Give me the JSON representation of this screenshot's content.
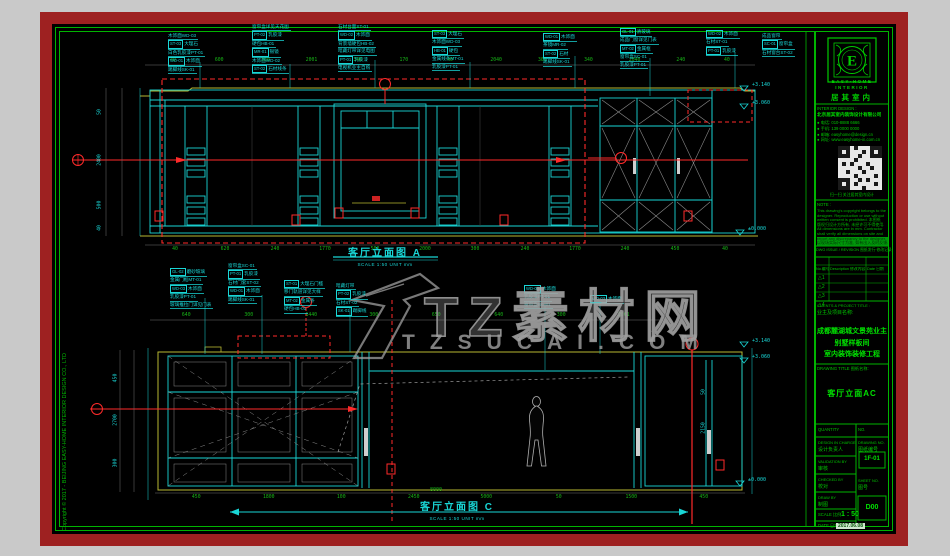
{
  "page": {
    "bg": "#c9c9c9",
    "frame": "#9e2121",
    "paper": "#000000",
    "border_green": "#00b400",
    "cyan": "#19d6d6",
    "yellow": "#b8b832",
    "red": "#ff2a2a",
    "dim_green": "#17b517",
    "gray": "#8f8f8f"
  },
  "copyright": "Copyright © 2017 - BEIJING EASY-HOME INTERIOR DESIGN CO., LTD",
  "logo": {
    "letter": "E",
    "en1": "EASY·HOME",
    "en2": "INTERIOR",
    "cn": "居其室内"
  },
  "title_block": {
    "interior_design_label": "INTERIOR DESIGN :",
    "company": "北京居其室内装饰设计有限公司",
    "contacts": [
      "● 电话: 010-8888 6666",
      "● 手机: 139 0000 0000",
      "● 邮箱: easyhome@design.cn",
      "● 网址: www.easyhome-in.com.cn"
    ],
    "qr_caption": "扫一扫 关注居其室内设计",
    "note_label": "NOTE :",
    "notes": [
      "This drawing's copyright belongs to the",
      "designer. Reproduction or use without",
      "written consent is prohibited. 本图纸",
      "版权归设计方所有, 未经许可不得使用.",
      "All dimensions are in mm. Contractor",
      "shall verify all dimensions on site and",
      "report any discrepancy to the designer.",
      "以现场实际尺寸为准, 如有出入及时反馈."
    ],
    "issue_label": "DWG ISSUE / REVISION 图纸发行·修改记录",
    "table": {
      "headers": [
        "No.编号",
        "Description 修改内容",
        "Date 日期"
      ],
      "rows": [
        "1",
        "2",
        "3",
        "4"
      ]
    },
    "clients_label": "CLIENTS & PROJECT TITLE :",
    "clients_label_cn": "业主及项目名称:",
    "project_lines": [
      "成都麓湖城文景苑业主",
      "别墅样板间",
      "室内装饰装修工程"
    ],
    "drawing_title_label": "DRAWING TITLE 图纸名称:",
    "drawing_title": "客厅立面AC",
    "quantity_label": "QUANTITY",
    "no_label": "NO.",
    "design_in_charge": "DESIGN IN CHARGE",
    "design_in_charge_cn": "设计负责人",
    "drawing_no_label": "DRAWING NO.",
    "drawing_no_cn": "图纸编号",
    "drawing_no": "1F-01",
    "validation_label": "VALIDATION BY",
    "validation_cn": "审核",
    "checked_label": "CHECKED BY",
    "checked_cn": "校对",
    "draw_label": "DRAW BY",
    "draw_cn": "制图",
    "sheet_label": "SHEET NO.",
    "sheet_cn": "图号",
    "sheet_no": "D00",
    "scale_label": "SCALE 比例",
    "scale_value": "1 : 50",
    "date_label": "DATE 日期",
    "date_value": "2017.06.08"
  },
  "watermark": {
    "big_text": "TZ素材网",
    "domain": "TZSUCAI.COM"
  },
  "drawing": {
    "elev_a": {
      "title": "客厅立面图 A",
      "scale_note": "SCALE 1:50   UNIT mm"
    },
    "elev_c": {
      "title": "客厅立面图 C",
      "scale_note": "SCALE 1:50   UNIT mm",
      "overall_dim": "8000"
    },
    "flags": [
      {
        "x": 752,
        "y": 82,
        "t": "+3.140"
      },
      {
        "x": 752,
        "y": 100,
        "t": "+3.060"
      },
      {
        "x": 748,
        "y": 226,
        "t": "±0.000"
      },
      {
        "x": 752,
        "y": 338,
        "t": "+3.140"
      },
      {
        "x": 752,
        "y": 354,
        "t": "+3.060"
      },
      {
        "x": 748,
        "y": 477,
        "t": "±0.000"
      }
    ],
    "dim_rows": [
      {
        "y": 58,
        "x1": 150,
        "x2": 750,
        "values": [
          "40",
          "600",
          "300",
          "2001",
          "340",
          "170",
          "40",
          "2040",
          "300",
          "340",
          "2040",
          "240",
          "40"
        ]
      },
      {
        "y": 247,
        "x1": 150,
        "x2": 750,
        "values": [
          "40",
          "620",
          "240",
          "1770",
          "500",
          "2000",
          "300",
          "240",
          "1770",
          "240",
          "450",
          "40"
        ]
      },
      {
        "y": 313,
        "x1": 155,
        "x2": 655,
        "values": [
          "640",
          "300",
          "1440",
          "300",
          "650",
          "640",
          "300",
          "2001"
        ]
      },
      {
        "y": 495,
        "x1": 160,
        "x2": 740,
        "values": [
          "450",
          "1800",
          "100",
          "2450",
          "5000",
          "50",
          "1500",
          "450"
        ]
      }
    ],
    "vdims": [
      {
        "x": 100,
        "y": 112,
        "t": "50"
      },
      {
        "x": 100,
        "y": 160,
        "t": "2400"
      },
      {
        "x": 100,
        "y": 205,
        "t": "500"
      },
      {
        "x": 100,
        "y": 228,
        "t": "40"
      },
      {
        "x": 116,
        "y": 378,
        "t": "450"
      },
      {
        "x": 116,
        "y": 420,
        "t": "2700"
      },
      {
        "x": 116,
        "y": 463,
        "t": "300"
      },
      {
        "x": 704,
        "y": 392,
        "t": "50"
      },
      {
        "x": 704,
        "y": 428,
        "t": "2150"
      }
    ],
    "callouts": [
      {
        "x": 168,
        "y": 33,
        "lines": [
          "木饰面WD-03",
          "[ST-03] 大理石",
          "白色乳胶漆PT-01",
          "[WD-01] 木饰面",
          "踢脚线SK-01"
        ]
      },
      {
        "x": 252,
        "y": 24,
        "lines": [
          "窗帘盒详见天花图",
          "[PT-02] 乳胶漆",
          "硬包HB-01",
          "[MR-01] 银镜",
          "木饰面WD-02",
          "[ST-02] 石材线条"
        ]
      },
      {
        "x": 338,
        "y": 24,
        "lines": [
          "石材台面ST-01",
          "[WD-02] 木饰面",
          "背景墙硬包HB-02",
          "暗藏灯带详见电图",
          "[PT-01] 乳胶漆",
          "电视机业主自购"
        ]
      },
      {
        "x": 432,
        "y": 30,
        "lines": [
          "[ST-03] 大理石",
          "木饰面WD-03",
          "[HB-01] 硬包",
          "金属线条MT-01",
          "乳胶漆PT-01"
        ]
      },
      {
        "x": 543,
        "y": 33,
        "lines": [
          "[WD-01] 木饰面",
          "茶镜MR-02",
          "[ST-02] 石材",
          "踢脚线SK-01"
        ]
      },
      {
        "x": 620,
        "y": 28,
        "lines": [
          "[GL-01] 清玻璃",
          "成品门窗详见门表",
          "[MT-02] 金属框",
          "窗帘盒SC-01",
          "乳胶漆PT-01"
        ]
      },
      {
        "x": 706,
        "y": 30,
        "lines": [
          "[WD-02] 木饰面",
          "石材ST-01",
          "[PT-01] 乳胶漆"
        ]
      },
      {
        "x": 762,
        "y": 33,
        "lines": [
          "成品窗帘",
          "[SC-01] 窗帘盒",
          "石材窗台ST-02"
        ]
      },
      {
        "x": 170,
        "y": 268,
        "lines": [
          "[GL-02] 磨砂玻璃",
          "金属门框MT-01",
          "[WD-03] 木饰面",
          "乳胶漆PT-01",
          "玻璃推拉门详见门表"
        ]
      },
      {
        "x": 228,
        "y": 263,
        "lines": [
          "窗帘盒SC-01",
          "[PT-01] 乳胶漆",
          "石材门套ST-02",
          "[WD-01] 木饰面",
          "踢脚线SK-01"
        ]
      },
      {
        "x": 284,
        "y": 280,
        "lines": [
          "[ST-01] 大理石门槛",
          "移门轨道详见大样",
          "[MT-02] 金属条",
          "硬包HB-01"
        ]
      },
      {
        "x": 336,
        "y": 283,
        "lines": [
          "暗藏灯带",
          "[PT-02] 乳胶漆",
          "石材ST-02",
          "[SK-01] 踢脚线"
        ]
      },
      {
        "x": 524,
        "y": 285,
        "lines": [
          "[WD-03] 木饰面",
          "乳胶漆PT-01",
          "窗帘盒SC-01"
        ]
      },
      {
        "x": 590,
        "y": 295,
        "lines": [
          "[WD-03] 木饰面"
        ]
      }
    ]
  }
}
